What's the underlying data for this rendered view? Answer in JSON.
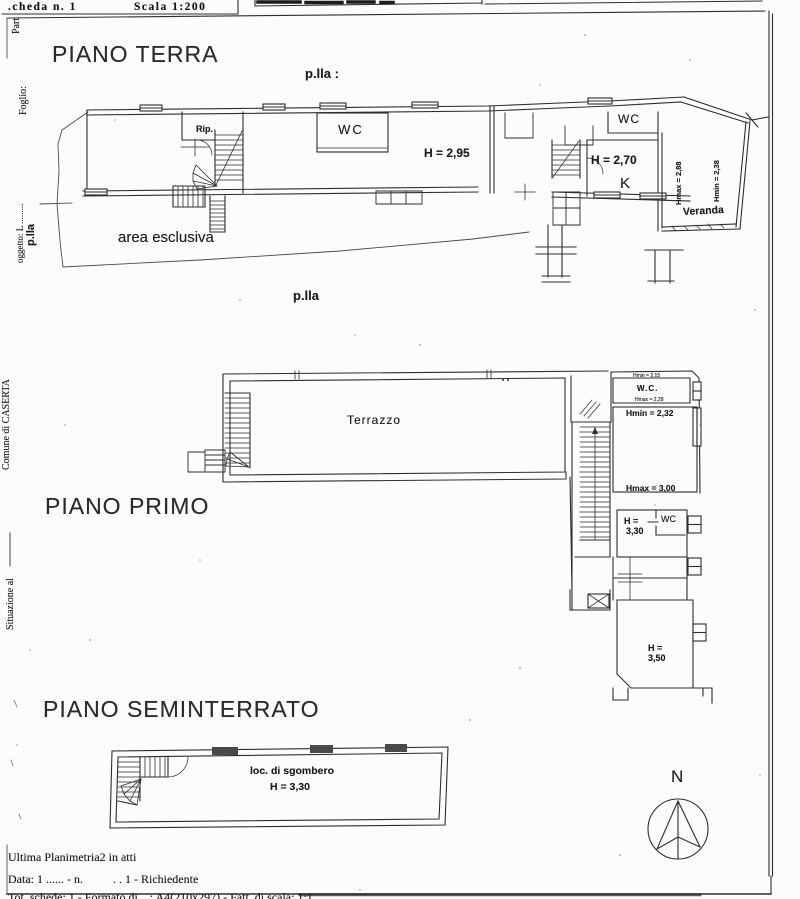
{
  "header": {
    "scheda": ".cheda n. 1",
    "scala": "Scala 1:200"
  },
  "margin": {
    "part": "Part",
    "foglio": "Foglio:",
    "oggetto": "oggetto: L .........",
    "plla": "p.lla",
    "comune": "Comune di CASERTA",
    "situazione": "Situazione al"
  },
  "ground_floor": {
    "title": "PIANO TERRA",
    "parcel_top": "p.lla :",
    "parcel_bottom": "p.lla",
    "labels": {
      "rip": "Rip.",
      "wc_closet": "WC",
      "hall_height": "H = 2,95",
      "wc_right": "WC",
      "kitchen_height": "H = 2,70",
      "kitchen": "K",
      "veranda_hmax": "Hmax = 2,88",
      "veranda_hmin": "Hmin = 2,38",
      "veranda": "Veranda",
      "area_esclusiva": "area esclusiva"
    }
  },
  "first_floor": {
    "title": "PIANO PRIMO",
    "labels": {
      "terrazzo": "Terrazzo",
      "wc_small": "W.C.",
      "wc_hmin": "Hmin = 2,15",
      "wc_hmax": "Hmax = 2,28",
      "room_hmin": "Hmin = 2,32",
      "room_hmax": "Hmax = 3,00",
      "room2_h": "H =",
      "room2_val": "3,30",
      "wc_mid": "WC",
      "room3_h": "H =",
      "room3_val": "3,50"
    }
  },
  "basement": {
    "title": "PIANO SEMINTERRATO",
    "labels": {
      "room": "loc. di sgombero",
      "height": "H = 3,30"
    }
  },
  "compass": {
    "north": "N"
  },
  "footer": {
    "note": "Ultima Planimetria2 in atti",
    "data_line": "Data: 1 ...... - n.          . . 1 - Richiedente",
    "format_line": "Tot. schede: 1 - Formato di ...: A4(210x297) - Fatt. di scala: 1:1"
  }
}
